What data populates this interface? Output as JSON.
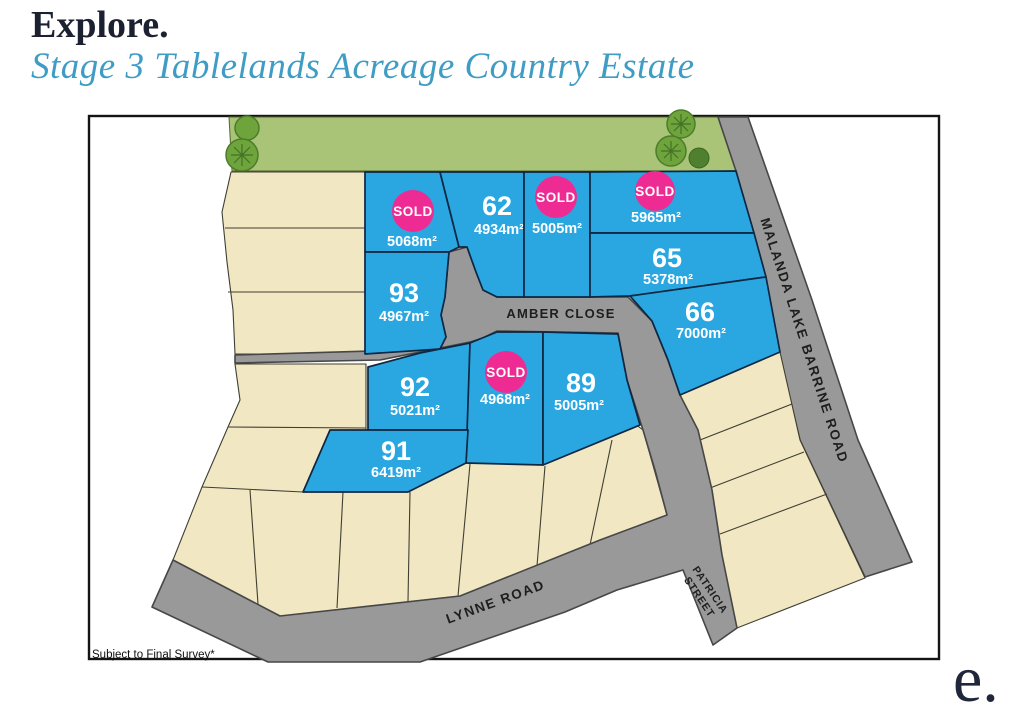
{
  "header": {
    "title": "Explore.",
    "subtitle": "Stage 3 Tablelands Acreage Country Estate"
  },
  "map": {
    "note": "Subject to Final Survey*",
    "sold_label": "SOLD",
    "roads": {
      "amber_close": {
        "name": "AMBER CLOSE"
      },
      "malanda": {
        "name": "MALANDA LAKE BARRINE ROAD"
      },
      "lynne": {
        "name": "LYNNE ROAD"
      },
      "patricia": {
        "line1": "PATRICIA",
        "line2": "STREET"
      }
    },
    "lots": [
      {
        "number": "",
        "area": "5068m²",
        "status": "sold"
      },
      {
        "number": "62",
        "area": "4934m²",
        "status": "available"
      },
      {
        "number": "",
        "area": "5005m²",
        "status": "sold"
      },
      {
        "number": "",
        "area": "5965m²",
        "status": "sold"
      },
      {
        "number": "65",
        "area": "5378m²",
        "status": "available"
      },
      {
        "number": "66",
        "area": "7000m²",
        "status": "available"
      },
      {
        "number": "93",
        "area": "4967m²",
        "status": "available"
      },
      {
        "number": "92",
        "area": "5021m²",
        "status": "available"
      },
      {
        "number": "",
        "area": "4968m²",
        "status": "sold"
      },
      {
        "number": "89",
        "area": "5005m²",
        "status": "available"
      },
      {
        "number": "91",
        "area": "6419m²",
        "status": "available"
      }
    ],
    "colors": {
      "available": "#2aa7e1",
      "sold": "#ee2b93",
      "road": "#9a999a",
      "other_stage": "#f1e7c2",
      "greenery": "#a9c377",
      "title": "#1b2130",
      "subtitle": "#3f9dc5"
    }
  },
  "logo": {
    "text": "e."
  }
}
